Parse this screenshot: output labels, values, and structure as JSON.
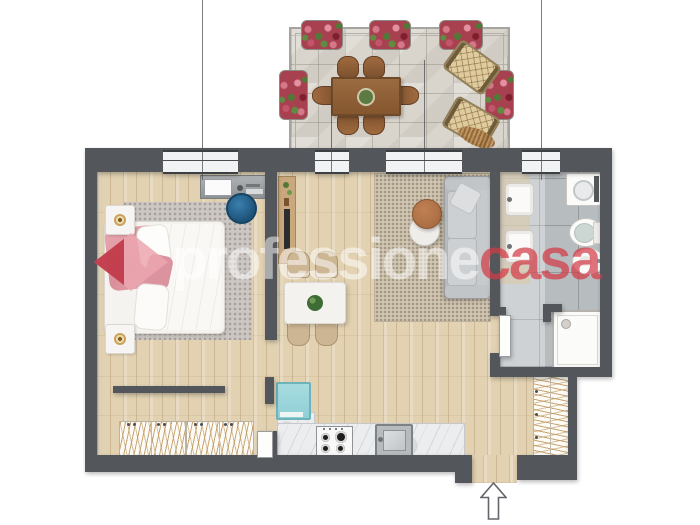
{
  "watermark": {
    "prefix": "professione",
    "suffix": "casa",
    "colors": {
      "diamond_pink": "#edaab3",
      "diamond_dark_red": "#bb2a3a",
      "text_red": "#d2464e",
      "text_white": "#ffffff"
    }
  },
  "palette": {
    "wall": "#53565a",
    "wood_floor": "#e2d2b2",
    "terrace_stone": "#d9d5cd",
    "bathroom_tile": "#c1c6c9",
    "bedroom_rug": "#ccc7c3",
    "living_rug": "#d2c8b6",
    "sofa_gray": "#bfc2c4",
    "kitchen_teal": "#9fd6db",
    "counter_marble": "#ecedee",
    "terrace_table_wood": "#8f6239",
    "flower_red": "#a8414f",
    "bed_pink": "#e8a7ae"
  },
  "entry": {
    "arrow_direction": "up"
  },
  "rooms": [
    {
      "name": "terrace",
      "items": [
        "dining-table",
        "six-chairs",
        "two-sun-loungers",
        "five-flower-boxes"
      ]
    },
    {
      "name": "bedroom",
      "items": [
        "double-bed",
        "two-nightstands",
        "candles",
        "desk",
        "round-chair",
        "rug"
      ]
    },
    {
      "name": "living-dining",
      "items": [
        "sofa",
        "two-coffee-tables",
        "rug",
        "square-table",
        "four-chairs",
        "tv-console"
      ]
    },
    {
      "name": "kitchen",
      "items": [
        "fridge",
        "counter",
        "gas-hob",
        "sink"
      ]
    },
    {
      "name": "bathroom",
      "items": [
        "two-washbasins",
        "toilet",
        "bidet",
        "washing-machine",
        "shower"
      ]
    },
    {
      "name": "hallway",
      "items": [
        "wardrobes",
        "entry-door"
      ]
    }
  ]
}
